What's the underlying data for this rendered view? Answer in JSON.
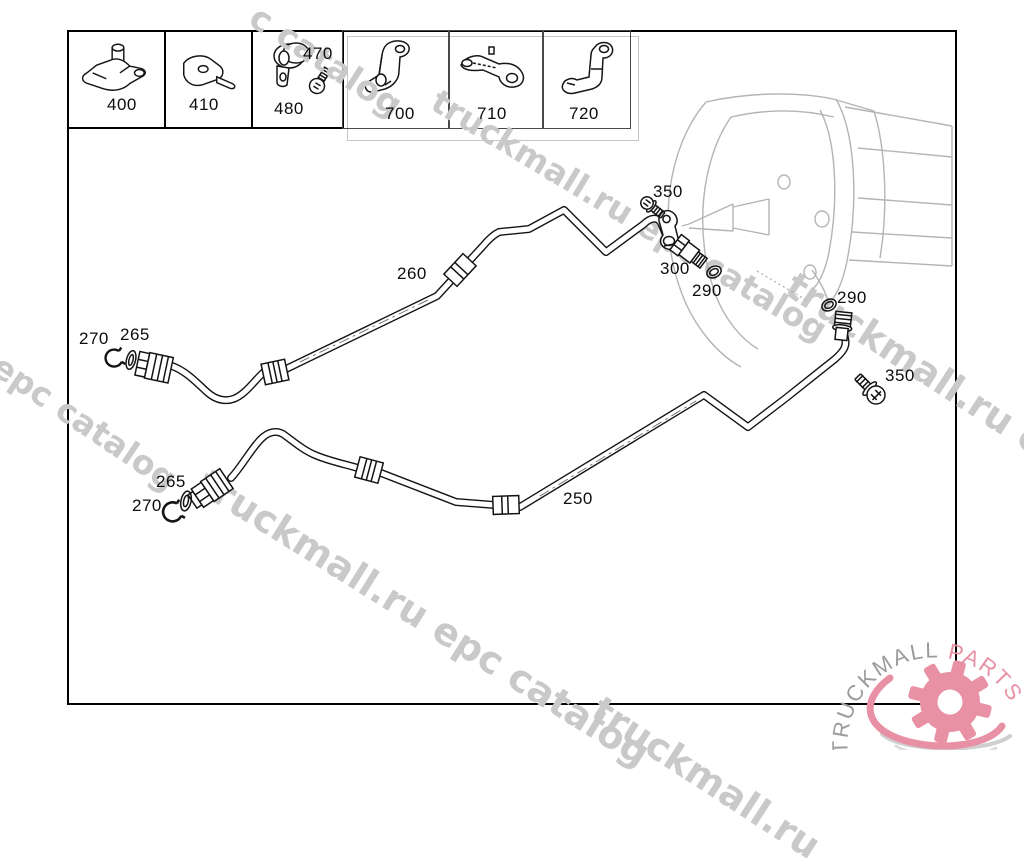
{
  "watermark": {
    "text": "truckmall.ru epc catalog",
    "fragments": [
      "c catalog",
      "truckmall.ru epc catalog",
      "l epc catalog",
      "truckmall.ru epc catalog",
      "truckmall.ru epc",
      "truckmall.ru"
    ]
  },
  "parts_table": {
    "cells": [
      {
        "id": "400",
        "label": "400"
      },
      {
        "id": "410",
        "label": "410"
      },
      {
        "id": "480",
        "label": "480"
      },
      {
        "id": "700",
        "label": "700"
      },
      {
        "id": "710",
        "label": "710"
      },
      {
        "id": "720",
        "label": "720"
      }
    ]
  },
  "callouts": {
    "c470": "470",
    "c260": "260",
    "c250": "250",
    "c350_upper": "350",
    "c300": "300",
    "c290_upper": "290",
    "c290_right": "290",
    "c350_right": "350",
    "c270_upper": "270",
    "c265_upper": "265",
    "c265_lower": "265",
    "c270_lower": "270"
  },
  "logo": {
    "brand_gray": "TRUCKMALL",
    "brand_accent": "PARTS"
  },
  "colors": {
    "accent_pink": "#e891a4",
    "watermark_gray": "#c9c9c9",
    "line_black": "#141414",
    "housing_gray": "#b4b4b4",
    "logo_gray": "#9b9b9b"
  }
}
